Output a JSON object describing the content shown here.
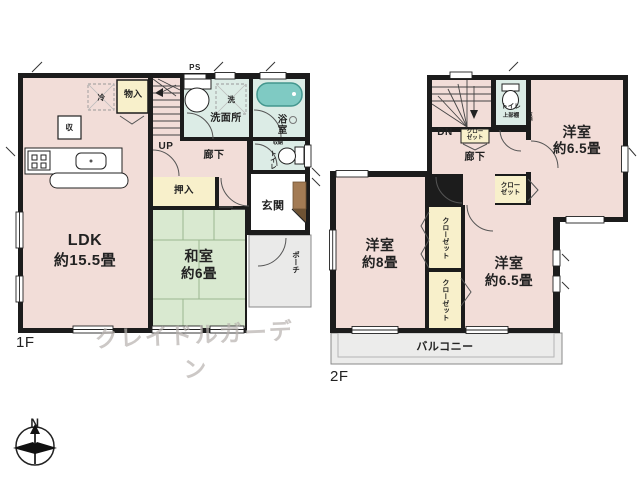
{
  "watermark": "クレイドルガーデン",
  "compass": {
    "north_label": "N"
  },
  "floor1": {
    "floor_label": "1F",
    "ldk": {
      "name": "LDK",
      "area": "約15.5畳"
    },
    "washitsu": {
      "name": "和室",
      "area": "約6畳"
    },
    "senmenjo": "洗面所",
    "yokushitsu": "浴室",
    "rouka": "廊下",
    "toilet": "トイレ",
    "toilet_storage": "収納",
    "genkan": "玄関",
    "porch": "ポーチ",
    "oshiire": "押入",
    "monoire": "物入",
    "storage_box": "収",
    "fridge_space": "冷",
    "washer_space": "洗",
    "pipe_space": "PS",
    "stairs_label": "UP"
  },
  "floor2": {
    "floor_label": "2F",
    "stairs_label": "DN",
    "toilet": "トイレ",
    "toilet_shelf": "上部棚",
    "toilet_storage": "収納",
    "closet_line1": "クロー",
    "closet_line2": "ゼット",
    "room_a": {
      "name": "洋室",
      "area": "約6.5畳"
    },
    "room_b": {
      "name": "洋室",
      "area": "約8畳"
    },
    "room_c": {
      "name": "洋室",
      "area": "約6.5畳"
    },
    "rouka": "廊下",
    "balcony": "バルコニー"
  },
  "colors": {
    "wall": "#1c1c1c",
    "room_pink": "#f2ddd8",
    "tatami_green": "#d9e9d0",
    "wet_area_teal": "#dcece6",
    "closet_cream": "#f8f0cb",
    "bathtub_teal": "#7fcac3",
    "porch_gray": "#eaeae9",
    "entrance_cabinet_brown": "#a37b54"
  }
}
